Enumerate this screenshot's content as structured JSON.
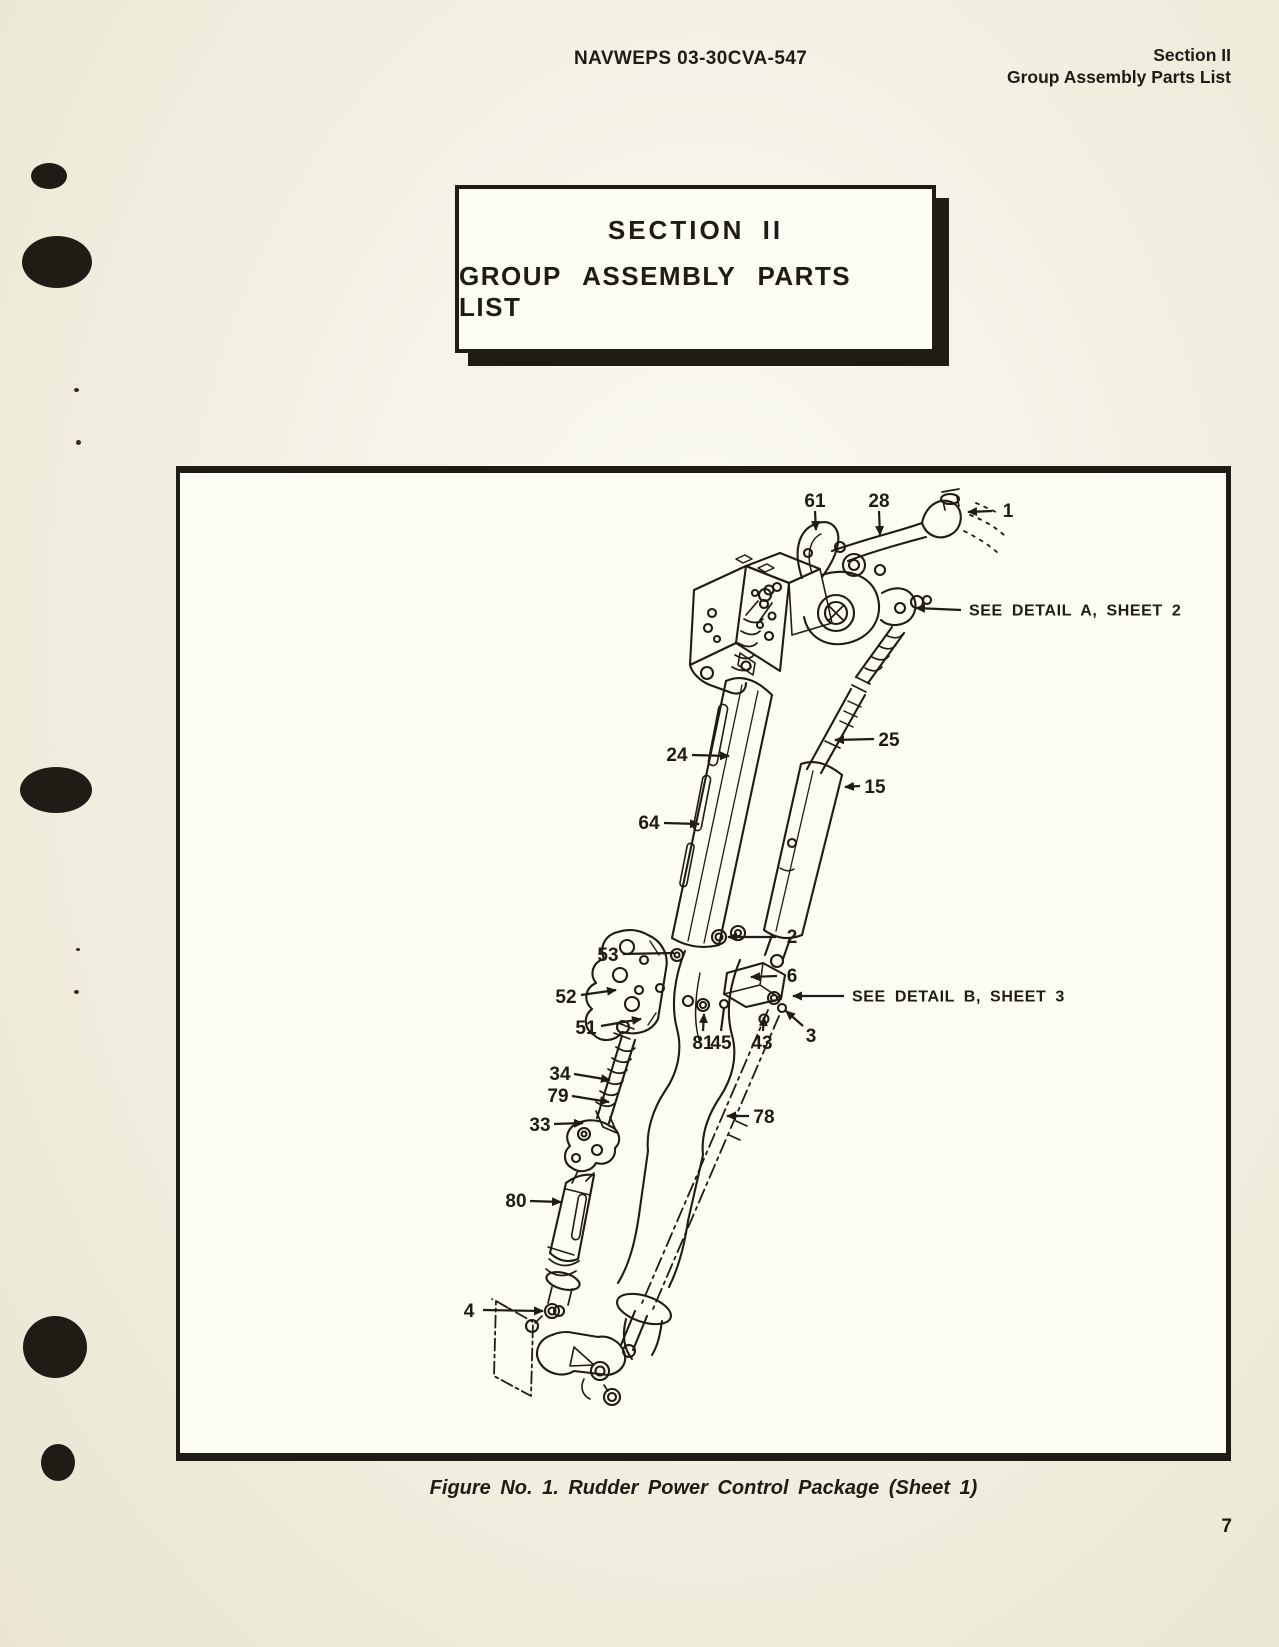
{
  "header": {
    "doc_number": "NAVWEPS 03-30CVA-547",
    "section_label": "Section II",
    "section_sublabel": "Group Assembly Parts List"
  },
  "title_box": {
    "line1": "SECTION II",
    "line2": "GROUP ASSEMBLY PARTS LIST"
  },
  "figure": {
    "caption": "Figure No. 1. Rudder Power Control Package (Sheet 1)",
    "callouts": [
      {
        "label": "61",
        "tx": 635,
        "ty": 27,
        "lx1": 635,
        "ly1": 38,
        "lx2": 636,
        "ly2": 57,
        "arrow": true
      },
      {
        "label": "28",
        "tx": 699,
        "ty": 27,
        "lx1": 699,
        "ly1": 38,
        "lx2": 700,
        "ly2": 62,
        "arrow": true
      },
      {
        "label": "1",
        "tx": 828,
        "ty": 37,
        "lx1": 812,
        "ly1": 38,
        "lx2": 788,
        "ly2": 39,
        "arrow": true
      },
      {
        "label": "SEE DETAIL A, SHEET 2",
        "tx": 789,
        "ty": 137,
        "lx1": 781,
        "ly1": 137,
        "lx2": 736,
        "ly2": 135,
        "arrow": true,
        "note": true,
        "anchor": "start"
      },
      {
        "label": "24",
        "tx": 497,
        "ty": 281,
        "lx1": 512,
        "ly1": 282,
        "lx2": 549,
        "ly2": 283,
        "arrow": true
      },
      {
        "label": "25",
        "tx": 709,
        "ty": 266,
        "lx1": 694,
        "ly1": 266,
        "lx2": 655,
        "ly2": 267,
        "arrow": true
      },
      {
        "label": "15",
        "tx": 695,
        "ty": 313,
        "lx1": 680,
        "ly1": 313,
        "lx2": 665,
        "ly2": 314,
        "arrow": true
      },
      {
        "label": "64",
        "tx": 469,
        "ty": 349,
        "lx1": 484,
        "ly1": 350,
        "lx2": 519,
        "ly2": 351,
        "arrow": true
      },
      {
        "label": "2",
        "tx": 612,
        "ty": 463,
        "lx1": 596,
        "ly1": 464,
        "lx2": 548,
        "ly2": 464,
        "arrow": true
      },
      {
        "label": "53",
        "tx": 428,
        "ty": 481,
        "lx1": 443,
        "ly1": 481,
        "lx2": 494,
        "ly2": 480,
        "arrow": false
      },
      {
        "label": "52",
        "tx": 386,
        "ty": 523,
        "lx1": 401,
        "ly1": 522,
        "lx2": 436,
        "ly2": 517,
        "arrow": true
      },
      {
        "label": "51",
        "tx": 406,
        "ty": 554,
        "lx1": 421,
        "ly1": 553,
        "lx2": 461,
        "ly2": 546,
        "arrow": true
      },
      {
        "label": "6",
        "tx": 612,
        "ty": 502,
        "lx1": 597,
        "ly1": 503,
        "lx2": 571,
        "ly2": 504,
        "arrow": true
      },
      {
        "label": "SEE DETAIL B, SHEET 3",
        "tx": 672,
        "ty": 523,
        "lx1": 664,
        "ly1": 523,
        "lx2": 613,
        "ly2": 523,
        "arrow": true,
        "note": true,
        "anchor": "start"
      },
      {
        "label": "3",
        "tx": 631,
        "ty": 562,
        "lx1": 623,
        "ly1": 553,
        "lx2": 606,
        "ly2": 538,
        "arrow": true
      },
      {
        "label": "81",
        "tx": 523,
        "ty": 569,
        "lx1": 523,
        "ly1": 558,
        "lx2": 524,
        "ly2": 541,
        "arrow": true
      },
      {
        "label": "45",
        "tx": 541,
        "ty": 569,
        "lx1": 541,
        "ly1": 558,
        "lx2": 544,
        "ly2": 535,
        "arrow": false
      },
      {
        "label": "43",
        "tx": 582,
        "ty": 569,
        "lx1": 583,
        "ly1": 558,
        "lx2": 584,
        "ly2": 544,
        "arrow": true
      },
      {
        "label": "34",
        "tx": 380,
        "ty": 600,
        "lx1": 394,
        "ly1": 601,
        "lx2": 430,
        "ly2": 607,
        "arrow": true
      },
      {
        "label": "79",
        "tx": 378,
        "ty": 622,
        "lx1": 392,
        "ly1": 623,
        "lx2": 429,
        "ly2": 629,
        "arrow": true
      },
      {
        "label": "33",
        "tx": 360,
        "ty": 651,
        "lx1": 374,
        "ly1": 651,
        "lx2": 403,
        "ly2": 650,
        "arrow": true
      },
      {
        "label": "78",
        "tx": 584,
        "ty": 643,
        "lx1": 569,
        "ly1": 643,
        "lx2": 547,
        "ly2": 643,
        "arrow": true
      },
      {
        "label": "80",
        "tx": 336,
        "ty": 727,
        "lx1": 350,
        "ly1": 728,
        "lx2": 381,
        "ly2": 729,
        "arrow": true
      },
      {
        "label": "4",
        "tx": 289,
        "ty": 837,
        "lx1": 303,
        "ly1": 837,
        "lx2": 363,
        "ly2": 838,
        "arrow": true
      }
    ]
  },
  "footer": {
    "page_number": "7"
  },
  "colors": {
    "ink": "#1f1b15",
    "paper": "#f2efe1",
    "figure_background": "#fcfbf4"
  }
}
